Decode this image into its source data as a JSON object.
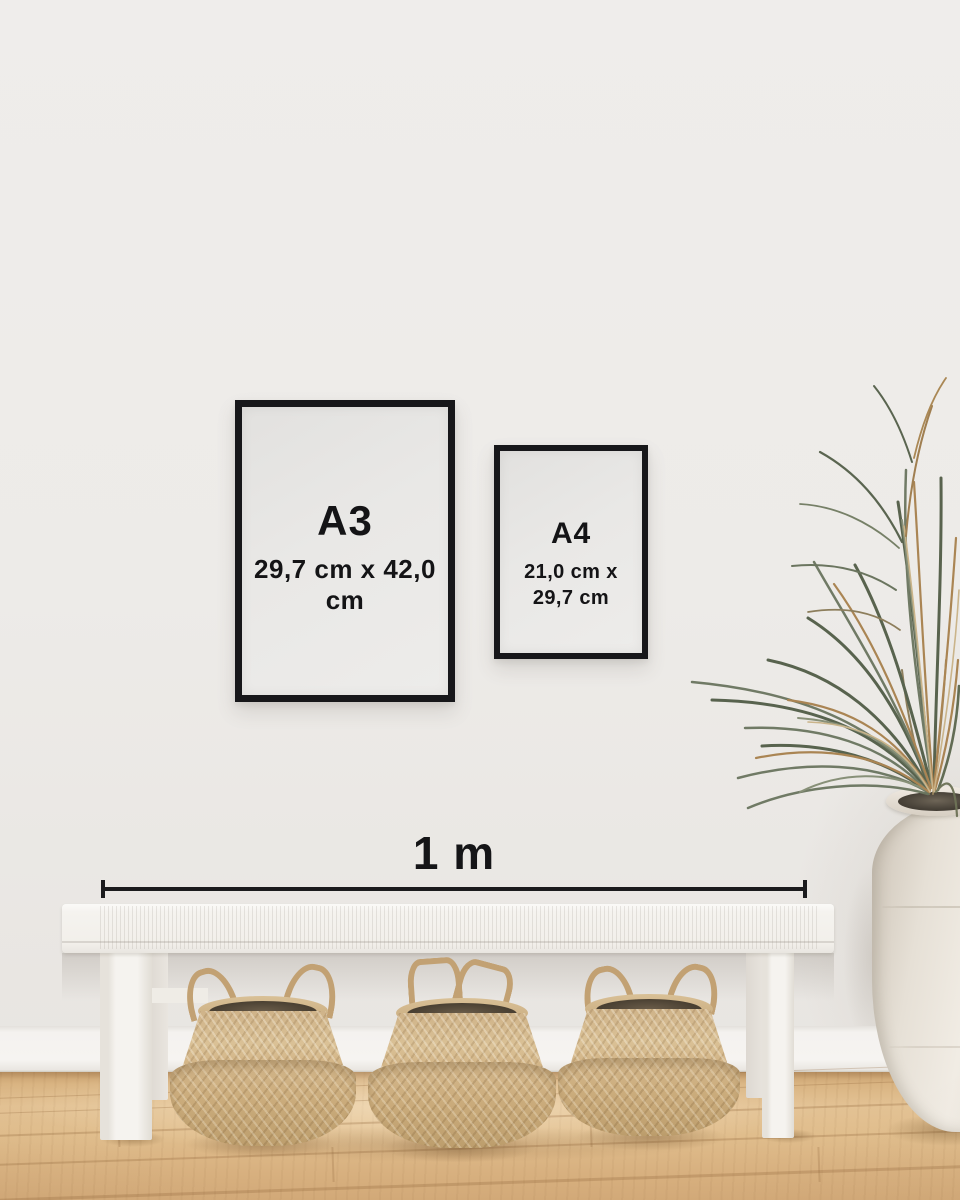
{
  "frames": {
    "a3": {
      "label": "A3",
      "dimensions": "29,7 cm x 42,0 cm"
    },
    "a4": {
      "label": "A4",
      "dimensions_line1": "21,0 cm x",
      "dimensions_line2": "29,7 cm"
    }
  },
  "scale_bar": {
    "label": "1 m"
  },
  "palette": {
    "wall": "#edebe8",
    "baseboard": "#f4f2ef",
    "frame_black": "#17171a",
    "poster_paper": "#e8e6e3",
    "text": "#141416",
    "scale_line": "#1b1b1d",
    "floor_wood": "#ddb887",
    "bench_white": "#f5f3ef",
    "basket_seagrass": "#cbae80",
    "vase_white": "#eae4da",
    "plant_green": "#5e6951",
    "plant_dried": "#a8814e"
  },
  "objects": {
    "plant": "dried-palm-plant",
    "vase": "white-floor-vase",
    "bench": "white-woven-bench",
    "baskets": "seagrass-belly-baskets",
    "floor": "oak-wood-floor"
  }
}
